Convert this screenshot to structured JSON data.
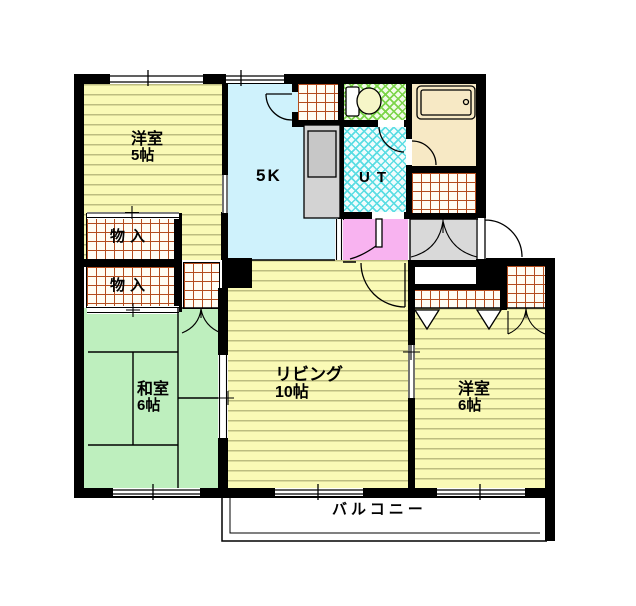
{
  "rooms": {
    "western5": {
      "label": "洋室",
      "area": "5帖"
    },
    "kitchen": {
      "label": "5K"
    },
    "utility": {
      "label": "UT"
    },
    "closet_upper": {
      "label": "物入"
    },
    "closet_lower": {
      "label": "物入"
    },
    "japanese": {
      "label": "和室",
      "area": "6帖"
    },
    "living": {
      "label": "リビング",
      "area": "10帖"
    },
    "western6": {
      "label": "洋室",
      "area": "6帖"
    },
    "balcony": {
      "label": "バルコニー"
    }
  },
  "fixtures": [
    "toilet-icon",
    "bathtub-icon",
    "kitchen-counter",
    "entrance-door",
    "window",
    "sliding-door",
    "folding-door",
    "door-swing"
  ],
  "colors": {
    "wall": "#000000",
    "western_room": "#FAFAB6",
    "floor_stripe": "#BDBD80",
    "japanese_room": "#BEEFBE",
    "kitchen_floor": "#CFF2FC",
    "bath": "#F7E9C5",
    "hall": "#F8B3F0",
    "entrance": "#D9D9D9",
    "tile_line": "#B34D1F",
    "utility_hatch": "#5ADDE3",
    "toilet_hatch": "#7CD54A"
  }
}
